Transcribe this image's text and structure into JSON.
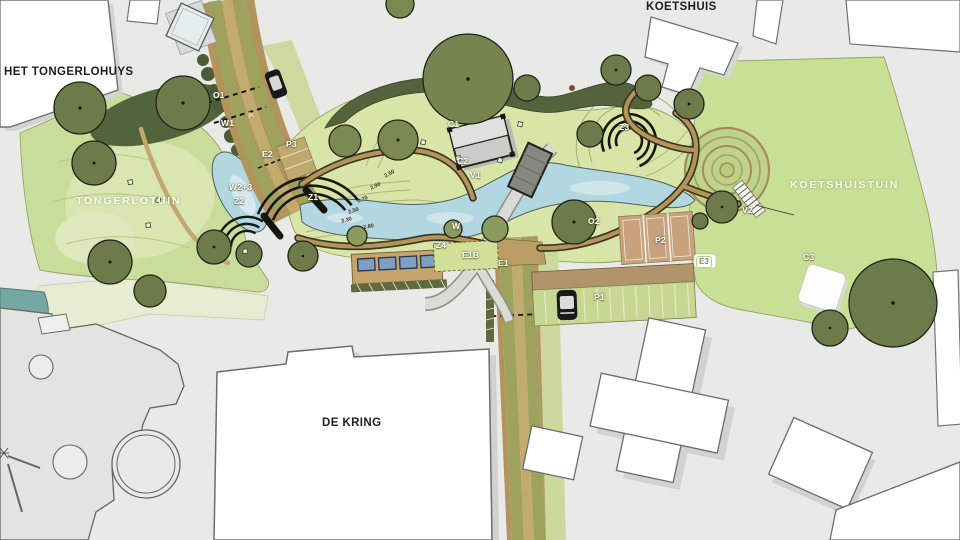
{
  "plan": {
    "title_labels_note": "site plan labels",
    "palette": {
      "background": "#e9eae8",
      "lawn": "#c9dd9b",
      "lawn_east": "#c8df96",
      "garden": "#d8e5a6",
      "water": "#b3d7e1",
      "tree_dark": "#6d7b4b",
      "tree_mid": "#7a8852",
      "tree_light": "#8b9a5e",
      "hedge": "#53643c",
      "road_olive": "#9fa25c",
      "road_tan": "#c2ab6f",
      "path_tan": "#b49457",
      "court": "#c7a27c",
      "bench_blue": "#7e9ec2",
      "building": "#ffffff"
    },
    "labels": [
      {
        "name": "het-tongerlohuys",
        "text": "HET TONGERLOHUYS",
        "kind": "building",
        "x": 4,
        "y": 67
      },
      {
        "name": "koetshuis",
        "text": "KOETSHUIS",
        "kind": "building",
        "x": 646,
        "y": 2
      },
      {
        "name": "de-kring",
        "text": "DE KRING",
        "kind": "building",
        "x": 322,
        "y": 418
      },
      {
        "name": "tongerlotuin",
        "text": "TONGERLOTUIN",
        "kind": "area",
        "x": 76,
        "y": 196
      },
      {
        "name": "koetshuistuin",
        "text": "KOETSHUISTUIN",
        "kind": "area",
        "x": 790,
        "y": 180
      },
      {
        "name": "zone-o1",
        "text": "O1",
        "kind": "code",
        "x": 213,
        "y": 91
      },
      {
        "name": "zone-w1",
        "text": "W1",
        "kind": "code",
        "x": 221,
        "y": 119
      },
      {
        "name": "road-letter-a",
        "text": "A",
        "kind": "code-faint",
        "x": 246,
        "y": 112,
        "rot": -20
      },
      {
        "name": "zone-e2",
        "text": "E2",
        "kind": "code",
        "x": 262,
        "y": 150
      },
      {
        "name": "zone-p3",
        "text": "P3",
        "kind": "code",
        "x": 286,
        "y": 140
      },
      {
        "name": "zone-w23",
        "text": "W2+3",
        "kind": "code",
        "x": 229,
        "y": 183
      },
      {
        "name": "zone-z2",
        "text": "Z2",
        "kind": "code",
        "x": 234,
        "y": 197
      },
      {
        "name": "zone-z1",
        "text": "Z1",
        "kind": "code",
        "x": 308,
        "y": 193
      },
      {
        "name": "zone-z3",
        "text": "Z3",
        "kind": "code",
        "x": 619,
        "y": 123
      },
      {
        "name": "zone-c1",
        "text": "C1",
        "kind": "code",
        "x": 448,
        "y": 120
      },
      {
        "name": "zone-c2",
        "text": "C2",
        "kind": "code",
        "x": 457,
        "y": 157
      },
      {
        "name": "zone-v1",
        "text": "V1",
        "kind": "code",
        "x": 470,
        "y": 171
      },
      {
        "name": "zone-w",
        "text": "W",
        "kind": "code",
        "x": 452,
        "y": 222
      },
      {
        "name": "zone-o2",
        "text": "O2",
        "kind": "code",
        "x": 588,
        "y": 217
      },
      {
        "name": "zone-z4",
        "text": "Z4",
        "kind": "code",
        "x": 436,
        "y": 241
      },
      {
        "name": "zone-e1b",
        "text": "E1B",
        "kind": "code",
        "x": 462,
        "y": 251
      },
      {
        "name": "zone-e1",
        "text": "E1",
        "kind": "code",
        "x": 498,
        "y": 259
      },
      {
        "name": "zone-p2",
        "text": "P2",
        "kind": "code",
        "x": 655,
        "y": 236
      },
      {
        "name": "zone-p1",
        "text": "P1",
        "kind": "code",
        "x": 594,
        "y": 293
      },
      {
        "name": "zone-v2",
        "text": "V2",
        "kind": "code",
        "x": 742,
        "y": 206
      },
      {
        "name": "zone-c3",
        "text": "C3",
        "kind": "code",
        "x": 803,
        "y": 253
      },
      {
        "name": "zone-e3",
        "text": "E3",
        "kind": "badge",
        "x": 696,
        "y": 256
      },
      {
        "name": "contour-1",
        "text": "2.50",
        "kind": "contour",
        "x": 384,
        "y": 175,
        "rot": -28
      },
      {
        "name": "contour-2",
        "text": "2.90",
        "kind": "contour",
        "x": 370,
        "y": 187,
        "rot": -25
      },
      {
        "name": "contour-3",
        "text": "2.70",
        "kind": "contour",
        "x": 357,
        "y": 200,
        "rot": -22
      },
      {
        "name": "contour-4",
        "text": "2.50",
        "kind": "contour",
        "x": 348,
        "y": 211,
        "rot": -18
      },
      {
        "name": "contour-5",
        "text": "2.30",
        "kind": "contour",
        "x": 341,
        "y": 220,
        "rot": -15
      },
      {
        "name": "contour-6",
        "text": "2.80",
        "kind": "contour",
        "x": 363,
        "y": 226,
        "rot": -10
      }
    ]
  }
}
